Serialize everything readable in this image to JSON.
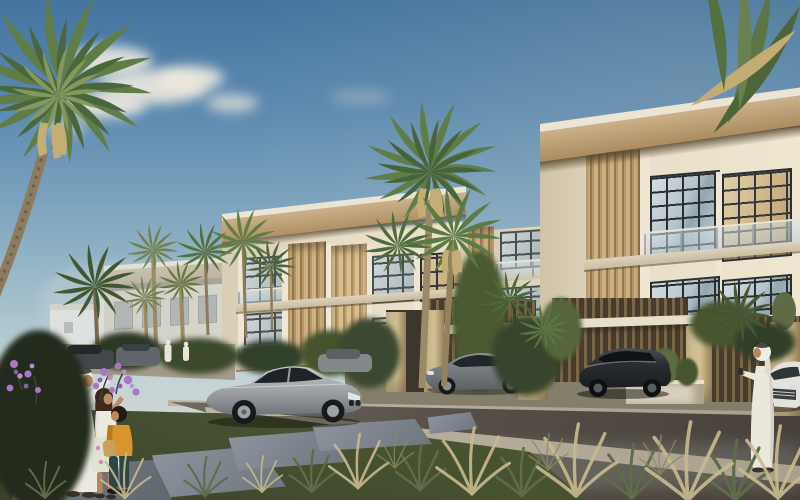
{
  "meta": {
    "kind": "architectural rendering",
    "description": "Sunny street view of a modern beige townhouse community with fan palms, parked cars, a family admiring purple flowers on the lawn, and a man in a white thobe pointing at the homes."
  },
  "palette": {
    "sky_top": "#44749f",
    "sky_horizon": "#cdd7d3",
    "cloud": "#efeadf",
    "wall_cream": "#e6ddc8",
    "roof_tan": "#c2a478",
    "roof_white": "#ece5d6",
    "roof_shadow": "#6e5b44",
    "louver_tan": "#cdb083",
    "window_frame": "#2b2e31",
    "glass": "#b7c6cd",
    "road": "#554f48",
    "sidewalk": "#b7ae9e",
    "paver": "#8e8b77",
    "lawn": "#39432a",
    "stone": "#80878d",
    "palm_green": "#5f7d47",
    "palm_dry": "#c3ae76",
    "flower_purple": "#a473c0",
    "car_silver": "#a9adb0",
    "car_gray": "#6f7579",
    "car_dark": "#26292c",
    "car_white": "#e3e2dd",
    "thobe_white": "#ece9e1",
    "skin": "#b98a62",
    "shirt_orange": "#d9932f"
  },
  "scene": {
    "sky": {
      "label": "blue sky"
    },
    "clouds": {
      "label": "soft white clouds"
    },
    "buildings": {
      "near": {
        "label": "three-storey townhouse, near right"
      },
      "mid": {
        "label": "three-storey townhouse, middle row"
      },
      "far": {
        "label": "townhouse, far left row"
      },
      "distant": {
        "label": "distant white houses"
      },
      "gap": {
        "label": "recessed townhouse unit"
      }
    },
    "vehicles": {
      "coupe": {
        "label": "silver coupe parked on street"
      },
      "sedan": {
        "label": "gray sedan in driveway"
      },
      "suv": {
        "label": "dark car in driveway"
      },
      "white_car": {
        "label": "white car at far right"
      },
      "distant_cars": {
        "label": "distant parked cars"
      },
      "hazy_suv": {
        "label": "hazy parked car behind coupe"
      }
    },
    "people": {
      "father": {
        "label": "man in white thobe with family"
      },
      "girl": {
        "label": "girl reaching for flowers"
      },
      "boy": {
        "label": "boy in orange shirt"
      },
      "man_right": {
        "label": "man in white thobe pointing"
      },
      "distant_pedestrians": {
        "label": "distant pedestrians in white"
      }
    },
    "vegetation": {
      "palm_left": {
        "label": "fan palm, top left"
      },
      "palm_center": {
        "label": "tall twin fan palms"
      },
      "palm_right": {
        "label": "palm fronds, top right"
      },
      "palms_small": {
        "label": "small palms by far buildings"
      },
      "palms_gap": {
        "label": "palms between buildings"
      },
      "palm_bushy": {
        "label": "bushy palm by driveway"
      },
      "palm_dark_left": {
        "label": "dark palm, left"
      },
      "yucca": {
        "label": "yucca plants"
      },
      "flowers": {
        "label": "purple flowering shrubs"
      },
      "grasses": {
        "label": "ornamental roadside grasses"
      },
      "bushes": {
        "label": "landscape shrubs"
      },
      "cactus": {
        "label": "cactus planter"
      }
    },
    "ground": {
      "road": {
        "label": "asphalt street"
      },
      "sidewalk": {
        "label": "light concrete curb"
      },
      "curb_far": {
        "label": "far curb line"
      },
      "driveway": {
        "label": "paver driveway apron"
      },
      "parking_far": {
        "label": "distant parking area"
      },
      "lawn": {
        "label": "lawn with stepping stones"
      },
      "stone": {
        "label": "concrete stepping stone"
      }
    },
    "structures": {
      "garage": {
        "label": "louvered garage bay"
      },
      "canopy": {
        "label": "entry canopy slab"
      },
      "planter": {
        "label": "white planter box"
      },
      "pillar": {
        "label": "beige privacy pillar"
      }
    }
  }
}
